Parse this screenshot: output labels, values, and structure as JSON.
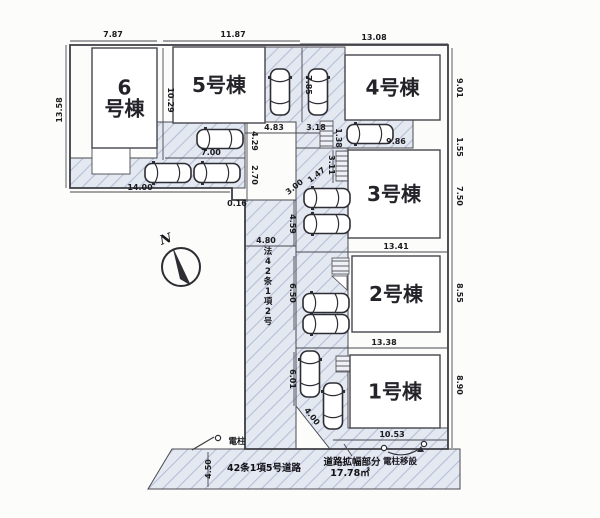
{
  "title": "区画図",
  "north": {
    "label": "N"
  },
  "colors": {
    "line": "#3c3c44",
    "text": "#1b1b20",
    "hatch_fill": "#e4e8f1",
    "hatch_line": "#b6bfd6",
    "building_fill": "#ffffff"
  },
  "buildings": [
    {
      "name": "6号棟",
      "lines": [
        "6",
        "号棟"
      ],
      "x": 92,
      "y": 48,
      "w": 65,
      "h": 100
    },
    {
      "name": "5号棟",
      "lines": [
        "5号棟"
      ],
      "x": 173,
      "y": 47,
      "w": 92,
      "h": 76
    },
    {
      "name": "4号棟",
      "lines": [
        "4号棟"
      ],
      "x": 345,
      "y": 55,
      "w": 95,
      "h": 65
    },
    {
      "name": "3号棟",
      "lines": [
        "3号棟"
      ],
      "x": 348,
      "y": 150,
      "w": 92,
      "h": 88
    },
    {
      "name": "2号棟",
      "lines": [
        "2号棟"
      ],
      "x": 352,
      "y": 256,
      "w": 88,
      "h": 76
    },
    {
      "name": "1号棟",
      "lines": [
        "1号棟"
      ],
      "x": 350,
      "y": 355,
      "w": 90,
      "h": 73
    }
  ],
  "dimensions": [
    {
      "v": "7.87",
      "x": 113,
      "y": 37,
      "r": 0
    },
    {
      "v": "11.87",
      "x": 233,
      "y": 37,
      "r": 0
    },
    {
      "v": "13.08",
      "x": 374,
      "y": 40,
      "r": 0
    },
    {
      "v": "13.58",
      "x": 62,
      "y": 110,
      "r": -90
    },
    {
      "v": "10.29",
      "x": 168,
      "y": 100,
      "r": 90
    },
    {
      "v": "7.85",
      "x": 306,
      "y": 85,
      "r": 90
    },
    {
      "v": "9.01",
      "x": 457,
      "y": 88,
      "r": 90
    },
    {
      "v": "4.83",
      "x": 274,
      "y": 130,
      "r": 0
    },
    {
      "v": "3.18",
      "x": 316,
      "y": 130,
      "r": 0
    },
    {
      "v": "1.38",
      "x": 336,
      "y": 138,
      "r": 90
    },
    {
      "v": "9.86",
      "x": 396,
      "y": 144,
      "r": 0
    },
    {
      "v": "1.55",
      "x": 457,
      "y": 147,
      "r": 90
    },
    {
      "v": "7.50",
      "x": 457,
      "y": 196,
      "r": 90
    },
    {
      "v": "7.00",
      "x": 211,
      "y": 155,
      "r": 0
    },
    {
      "v": "4.29",
      "x": 252,
      "y": 141,
      "r": 90
    },
    {
      "v": "2.70",
      "x": 252,
      "y": 175,
      "r": 90
    },
    {
      "v": "14.00",
      "x": 140,
      "y": 190,
      "r": 0
    },
    {
      "v": "0.16",
      "x": 237,
      "y": 206,
      "r": 0
    },
    {
      "v": "3.11",
      "x": 329,
      "y": 165,
      "r": 90
    },
    {
      "v": "1.47",
      "x": 318,
      "y": 177,
      "r": -38
    },
    {
      "v": "3.00",
      "x": 296,
      "y": 189,
      "r": -38
    },
    {
      "v": "4.59",
      "x": 290,
      "y": 224,
      "r": 90
    },
    {
      "v": "4.80",
      "x": 266,
      "y": 243,
      "r": 0
    },
    {
      "v": "13.41",
      "x": 396,
      "y": 249,
      "r": 0
    },
    {
      "v": "6.50",
      "x": 290,
      "y": 293,
      "r": 90
    },
    {
      "v": "8.55",
      "x": 457,
      "y": 293,
      "r": 90
    },
    {
      "v": "13.38",
      "x": 384,
      "y": 345,
      "r": 0
    },
    {
      "v": "6.01",
      "x": 290,
      "y": 379,
      "r": 90
    },
    {
      "v": "8.90",
      "x": 457,
      "y": 385,
      "r": 90
    },
    {
      "v": "4.00",
      "x": 310,
      "y": 418,
      "r": 52
    },
    {
      "v": "10.53",
      "x": 392,
      "y": 437,
      "r": 0
    },
    {
      "v": "4.50",
      "x": 211,
      "y": 469,
      "r": -90
    }
  ],
  "annotations": [
    {
      "text": "法42条1項2号",
      "x": 268,
      "y": 254,
      "vertical": true,
      "bold": false
    },
    {
      "text": "42条1項5号道路",
      "x": 264,
      "y": 471,
      "vertical": false,
      "bold": true
    },
    {
      "text": "道路拡幅部分",
      "x": 352,
      "y": 465,
      "vertical": false,
      "bold": true
    },
    {
      "text": "17.78㎡",
      "x": 350,
      "y": 476,
      "vertical": false,
      "bold": true
    },
    {
      "text": "電柱",
      "x": 237,
      "y": 444,
      "vertical": false,
      "bold": false
    },
    {
      "text": "電柱移設",
      "x": 400,
      "y": 464,
      "vertical": false,
      "bold": false
    }
  ],
  "cars": [
    {
      "x": 220,
      "y": 139,
      "r": 0
    },
    {
      "x": 168,
      "y": 173,
      "r": 0
    },
    {
      "x": 217,
      "y": 173,
      "r": 0
    },
    {
      "x": 280,
      "y": 92,
      "r": 90
    },
    {
      "x": 318,
      "y": 92,
      "r": 90
    },
    {
      "x": 370,
      "y": 134,
      "r": 0
    },
    {
      "x": 327,
      "y": 198,
      "r": 0
    },
    {
      "x": 327,
      "y": 224,
      "r": 0
    },
    {
      "x": 326,
      "y": 303,
      "r": 0
    },
    {
      "x": 326,
      "y": 324,
      "r": 0
    },
    {
      "x": 310,
      "y": 374,
      "r": 90
    },
    {
      "x": 333,
      "y": 406,
      "r": 90
    }
  ]
}
